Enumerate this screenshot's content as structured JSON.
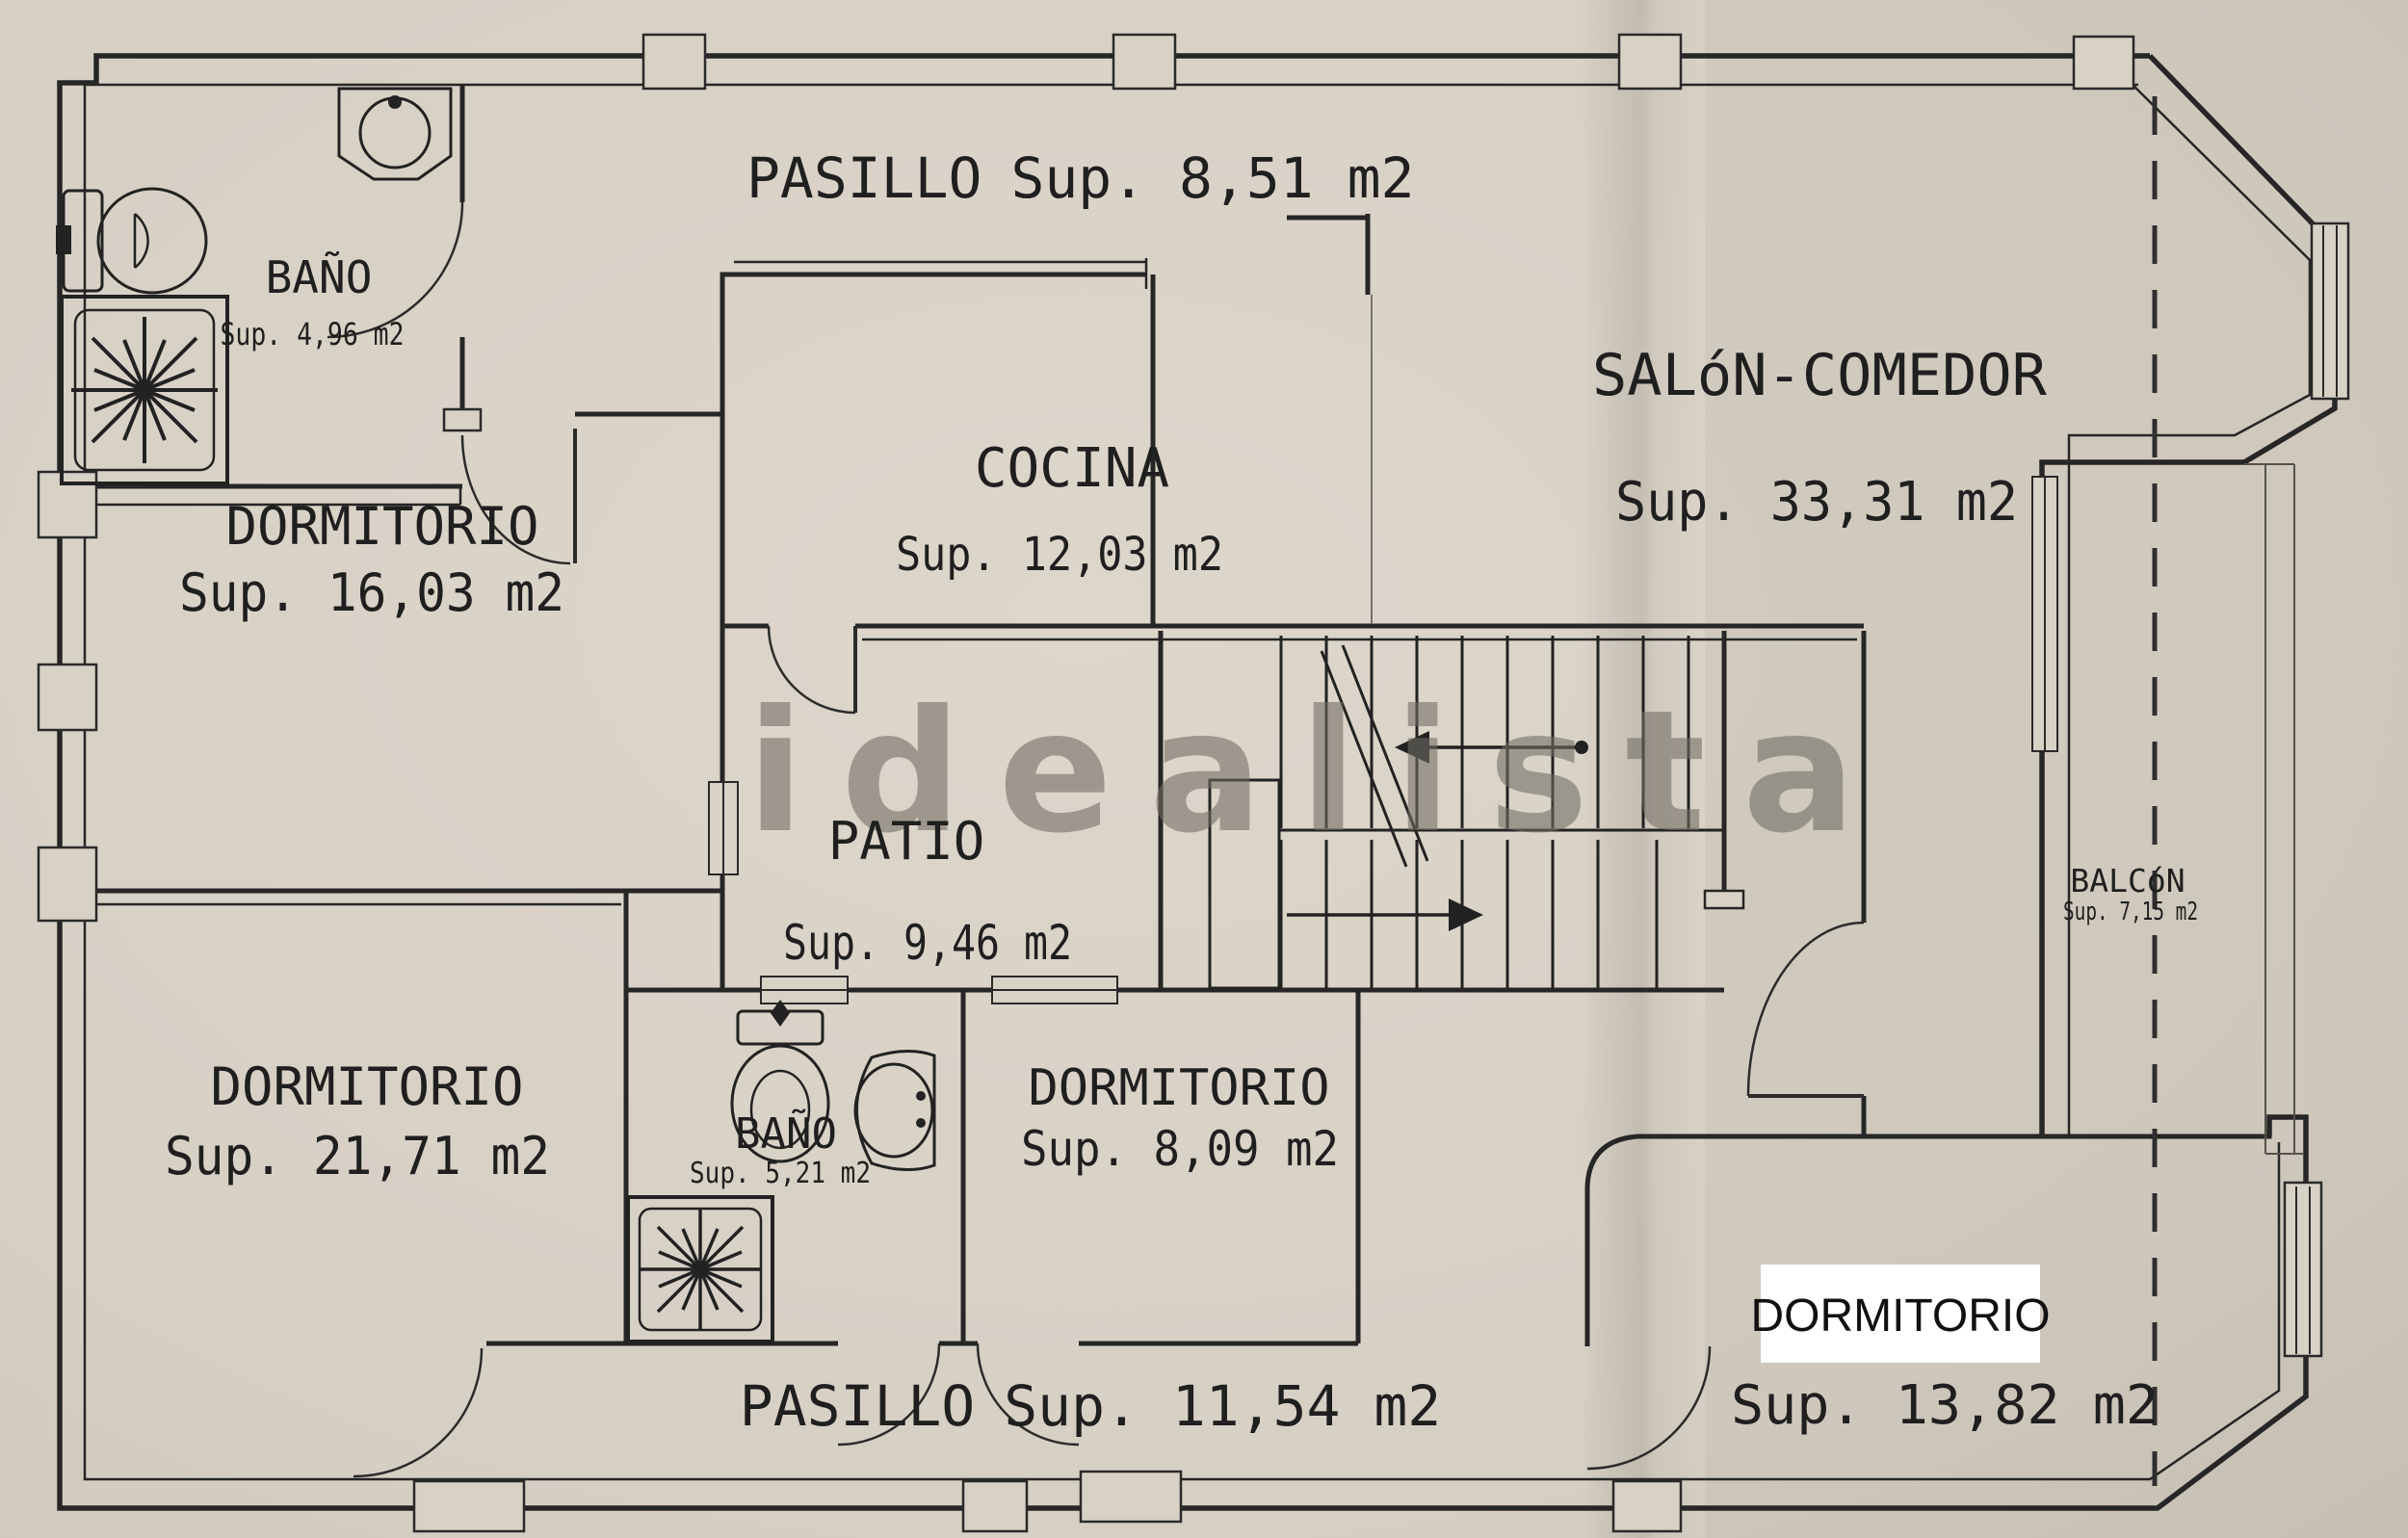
{
  "watermark": "idealista",
  "rooms": {
    "pasillo_top": {
      "name": "PASILLO",
      "sup": "Sup. 8,51 m2"
    },
    "bano_top": {
      "name": "BAÑO",
      "sup": "Sup. 4,96 m2"
    },
    "salon": {
      "name": "SALóN-COMEDOR",
      "sup": "Sup. 33,31 m2"
    },
    "cocina": {
      "name": "COCINA",
      "sup": "Sup. 12,03 m2"
    },
    "dormitorio_16": {
      "name": "DORMITORIO",
      "sup": "Sup. 16,03 m2"
    },
    "patio": {
      "name": "PATIO",
      "sup": "Sup. 9,46 m2"
    },
    "balcon": {
      "name": "BALCóN",
      "sup": "Sup. 7,15 m2"
    },
    "dormitorio_21": {
      "name": "DORMITORIO",
      "sup": "Sup. 21,71 m2"
    },
    "bano_bottom": {
      "name": "BAÑO",
      "sup": "Sup. 5,21 m2"
    },
    "dormitorio_8": {
      "name": "DORMITORIO",
      "sup": "Sup. 8,09 m2"
    },
    "dormitorio_13": {
      "name": "DORMITORIO",
      "sup": "Sup. 13,82 m2",
      "highlighted": true
    },
    "pasillo_bottom": {
      "name": "PASILLO",
      "sup": "Sup. 11,54 m2"
    }
  },
  "colors": {
    "paper": "#d8d1c6",
    "ink": "#262626",
    "watermark": "#78736a",
    "highlight_box": "#ffffff",
    "dashed_line": "#2f2f2f"
  }
}
